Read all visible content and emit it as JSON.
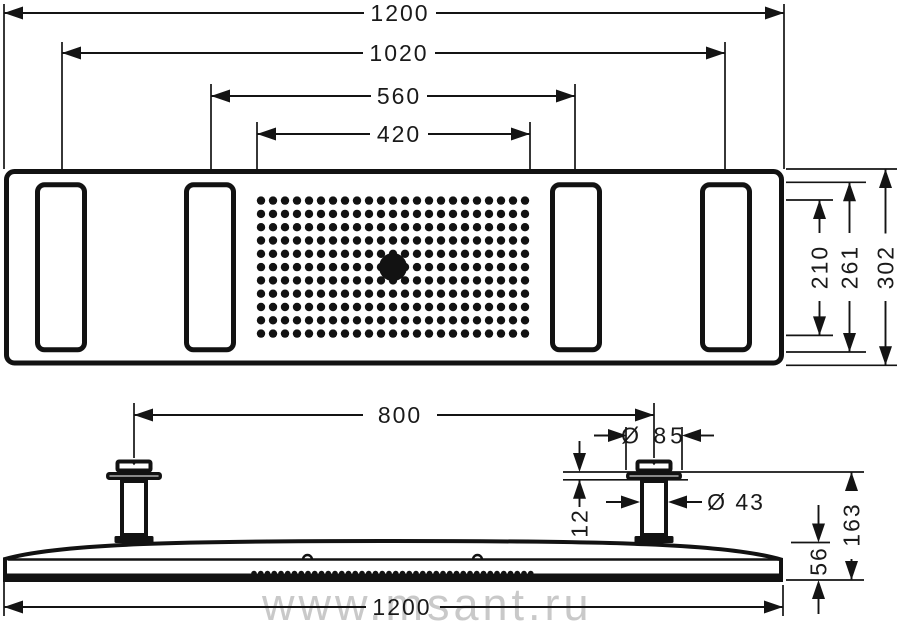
{
  "watermark": {
    "text": "www.msant.ru",
    "color": "#c9c9c9"
  },
  "colors": {
    "line": "#141414",
    "background": "#ffffff"
  },
  "plan_view": {
    "overall_width": "1200",
    "outer_slot_spacing": "1020",
    "inner_slot_spacing": "560",
    "spray_field_width": "420",
    "spray_field_depth": "210",
    "slot_length": "261",
    "overall_depth": "302",
    "nozzle_grid": {
      "cols": 23,
      "rows": 11,
      "x0": 261,
      "y0": 200.6,
      "dx": 12,
      "dy": 13.3,
      "dot_radius": 4.2,
      "center_outlet_x": 393,
      "center_outlet_y": 267.1,
      "center_outlet_radius": 14
    }
  },
  "side_view": {
    "connector_spacing": "800",
    "escutcheon_diameter": "Ø 85",
    "pipe_diameter": "Ø 43",
    "escutcheon_height": "12",
    "installation_depth": "163",
    "panel_thickness": "56",
    "overall_width": "1200",
    "nozzle_teeth": {
      "count": 42,
      "x0": 254,
      "dx": 6.75,
      "cy": 573.5,
      "r": 2.8
    }
  }
}
